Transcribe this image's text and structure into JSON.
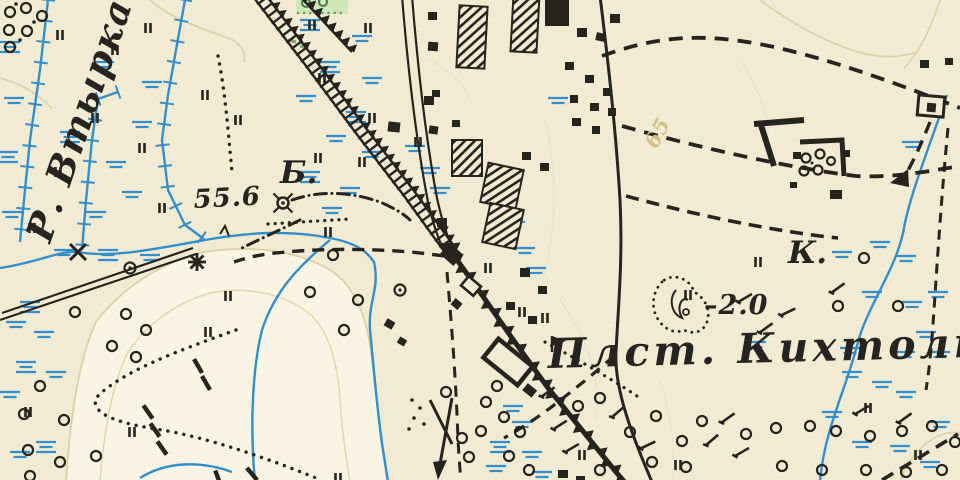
{
  "map": {
    "labels": {
      "river": "Р. Втырка",
      "spot_height": "55.6",
      "hill_letter": "Б.",
      "k_letter": "К.",
      "contour_value": "65",
      "depression_depth": "–2.0",
      "station": "Плст. Кихтолка."
    },
    "colors": {
      "paper": "#f2ebd4",
      "ink": "#26241f",
      "water": "#338fcb",
      "contour": "#d9cb9e",
      "vegetation_fill": "#cfe7ba",
      "vegetation_dot": "#5d9a50",
      "tan_label": "#d6bf85"
    },
    "legend_symbols": [
      "railway-ladder-icon",
      "railway-sawtooth-icon",
      "station-platform-icon",
      "stream-icon",
      "drainage-ditch-icon",
      "marsh-tick-icon",
      "tree-circle-icon",
      "orchard-patch-icon",
      "building-solid-icon",
      "building-hatched-icon",
      "windmill-icon",
      "mill-star-icon",
      "depression-icon",
      "dashed-road-icon",
      "dotted-path-icon",
      "contour-line-icon"
    ]
  }
}
